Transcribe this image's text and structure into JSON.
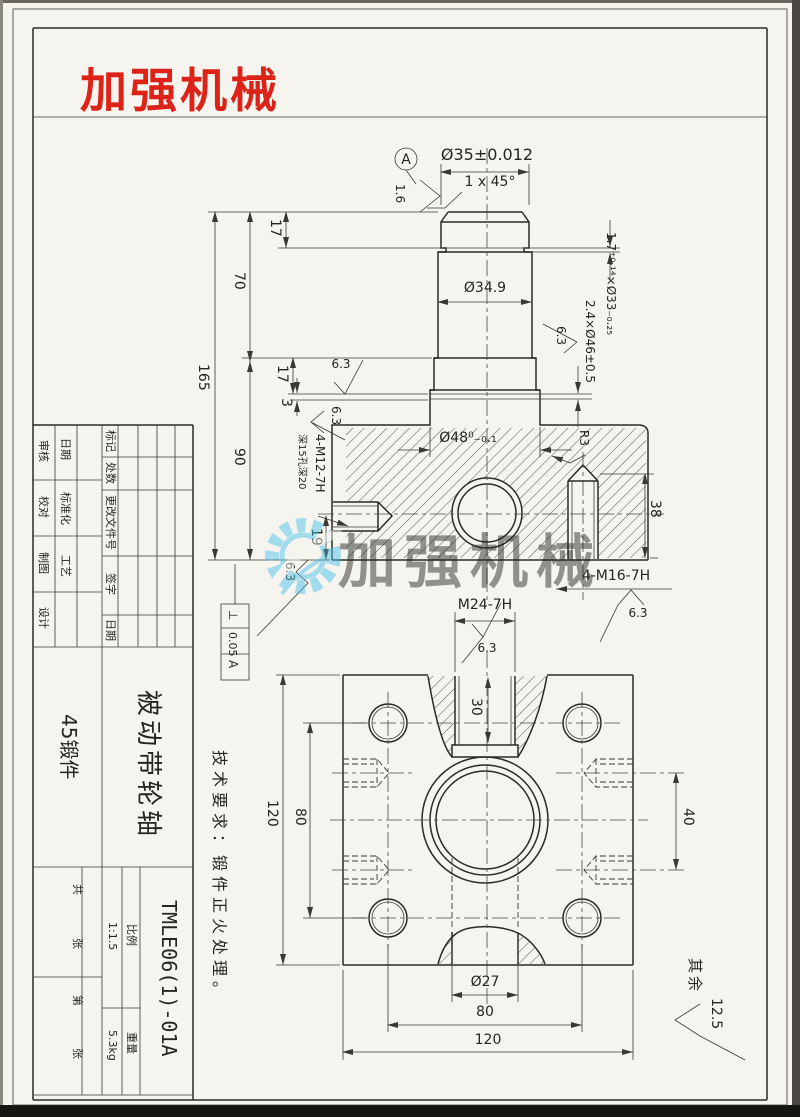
{
  "logo": {
    "text": "加强机械",
    "color": "#dd2318"
  },
  "watermark": {
    "text": "加强机械",
    "color": "#49c0e8"
  },
  "fv": {
    "dia35": "Ø35±0.012",
    "chamfer": "1 x 45°",
    "datumA": "A",
    "ra16": "1.6",
    "dia349": "Ø34.9",
    "dia48": "Ø48⁰₋₀.₁",
    "groove_33": "1.7⁺⁰·¹⁴×Ø33₋₀.₂₅",
    "groove_46": "2.4×Ø46±0.5",
    "r3": "R3",
    "d38": "38",
    "m16": "4-M16-7H",
    "m12": "4-M12-7H",
    "m12_note": "深15孔深20",
    "d165": "165",
    "d70": "70",
    "d90": "90",
    "d17a": "17",
    "d17b": "17",
    "d3": "3",
    "d19": "19",
    "ra63": "6.3",
    "fcf_sym": "⊥",
    "fcf_val": "0.05",
    "fcf_datum": "A"
  },
  "bv": {
    "m24": "M24-7H",
    "d30": "30",
    "d120_left": "120",
    "d80_left": "80",
    "d40": "40",
    "dia27": "Ø27",
    "d80_bottom": "80",
    "d120_bottom": "120"
  },
  "notes": {
    "tech_req": "技术要求：锻件正火处理。",
    "rest_label": "其余",
    "rest_value": "12.5"
  },
  "tb": {
    "h_biaoji": "标记",
    "h_chushu": "处数",
    "h_genggai": "更改文件号",
    "h_qianzi": "签字",
    "h_riqi": "日期",
    "r_shenhe": "审核",
    "r_jiaodui": "校对",
    "r_zhitu": "制图",
    "r_sheji": "设计",
    "r_riqi2": "日期",
    "r_biaozhunhua": "标准化",
    "r_gongyi": "工艺",
    "material": "45锻件",
    "part_name": "被动带轮轴",
    "drawing_no": "TMLE06(1)-01A",
    "scale_label": "比例",
    "scale_value": "1:1.5",
    "weight_label": "重量",
    "weight_value": "5.3kg",
    "sheet_gong": "共",
    "sheet_zhang1": "张",
    "sheet_di": "第",
    "sheet_zhang2": "张"
  }
}
